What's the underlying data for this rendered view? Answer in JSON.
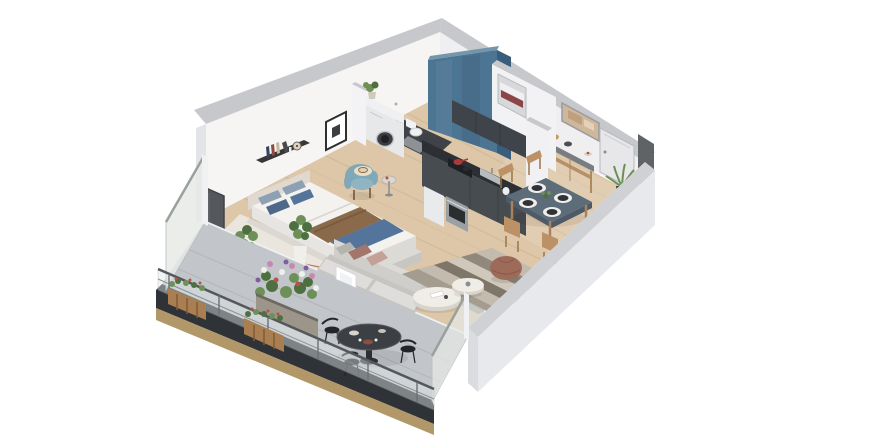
{
  "scene": {
    "type": "3d-isometric-apartment-floorplan-render",
    "background": "#ffffff",
    "rooms": [
      {
        "name": "bedroom",
        "furniture": [
          "double-bed",
          "headboard-shelf",
          "wall-art",
          "teal-armchair",
          "round-side-table",
          "window-plants",
          "beige-rug",
          "dark-window"
        ]
      },
      {
        "name": "bathroom",
        "furniture": [
          "blue-accent-wall",
          "vanity-sink",
          "washing-machine",
          "toilet",
          "bath-mat",
          "towel-niche"
        ]
      },
      {
        "name": "kitchen",
        "furniture": [
          "upper-cabinets",
          "dark-counter",
          "cooktop",
          "oven",
          "dishwasher",
          "sink"
        ]
      },
      {
        "name": "living-dining",
        "furniture": [
          "gray-sofa",
          "two-round-coffee-tables",
          "striped-rug",
          "leather-pouf",
          "dining-table",
          "dining-chairs",
          "console-table",
          "entry-door",
          "wall-art",
          "palm-plant",
          "dark-wardrobe-panel"
        ]
      },
      {
        "name": "balcony",
        "furniture": [
          "bistro-table",
          "bistro-chairs",
          "flower-planter",
          "railing-planter-boxes",
          "glass-railing",
          "frosted-privacy-screens",
          "concrete-floor"
        ]
      }
    ],
    "counts": {
      "dining_chairs": 4,
      "place_settings": 4,
      "bed_pillows": 4,
      "bistro_chairs": 3,
      "railing_posts": 6,
      "coffee_tables": 2,
      "railing_planters": 2
    },
    "colors": {
      "wallTop": "#c7c8cc",
      "wallFaceNW": "#f6f5f3",
      "wallFaceNE": "#efeff1",
      "wallCap": "#e3e4e7",
      "seWallTop": "#cfd1d5",
      "seWallFace": "#e8e9ec",
      "seWallInner": "#f4f4f2",
      "blueWall": "#4c7493",
      "blueWallSide": "#3a5d7c",
      "blueWallTop": "#7396ad",
      "woodFloor": "#ddc7a8",
      "plankLine": "#cbb390",
      "bathFloor": "#3f4348",
      "matGray": "#8e9296",
      "kitchenUpper": "#3f444a",
      "kitchenTop": "#2c3034",
      "kitchenFace": "#474c51",
      "steel": "#9ba0a5",
      "applianceWhite": "#e9eaec",
      "cooktopDark": "#1e2124",
      "potRed": "#a83c3c",
      "doorFace": "#e7e7e9",
      "doorEdge": "#b9bac0",
      "consoleWood": "#b08a5f",
      "consoleTop": "#787d82",
      "diningTop": "#5d6c79",
      "diningSide": "#4e5b66",
      "chairWood": "#bd9166",
      "chairWoodDark": "#9a7448",
      "plateDark": "#2f3338",
      "matWhite": "#f0efec",
      "artBeige": "#cfb79b",
      "artSmudge": "#b99877",
      "frameDark": "#2e2f31",
      "towelWhite": "#f0f0f2",
      "towelRed": "#8e4348",
      "nicheBack": "#d6d8da",
      "bedWhite": "#f3f2ef",
      "bedPlatform": "#e7e5e2",
      "bedFootSide": "#dcdad6",
      "headboard": "#e0d9cf",
      "pillowLight": "#8ea0b4",
      "pillowDark": "#4e6889",
      "pillowMid": "#54749c",
      "throwBrown": "#8b6a4c",
      "throwBrownDark": "#7a5b40",
      "throwBlue": "#54749c",
      "benchTop": "#dcdad7",
      "benchSide": "#c8c6c3",
      "rugBedroom": "#eae5dd",
      "rugStripeRed": "#b0614f",
      "sofaBase": "#c6c5c2",
      "sofaBack": "#cfcecb",
      "sofaBackTop": "#dbdad7",
      "sofaSeat": "#dedddb",
      "pillowBrown": "#a3766b",
      "pillowBlush": "#c4a198",
      "pillowGray": "#b5b3b0",
      "coffeeTop": "#f0ede7",
      "coffeeSide": "#d8d4cd",
      "rugBase": "#b7b0a5",
      "rugS1": "#a49c8e",
      "rugS2": "#c2bbae",
      "rugS3": "#7d7669",
      "rugS4": "#cfc8bb",
      "rugS5": "#8f887b",
      "pouf": "#9e6b5a",
      "poufDark": "#8a5a4a",
      "balconyFloor": "#c2c6ca",
      "balconySeam": "#b2b6ba",
      "slabDark": "#2f3236",
      "slabWood": "#b29869",
      "glass": "#dfe6e6",
      "glassFrame": "#a8adaf",
      "handrail": "#54585c",
      "midrail": "#8b9094",
      "post": "#6b7074",
      "screenGlass": "#e7eae7",
      "screenFrame": "#b9bfbc",
      "screenRail": "#9aa09c",
      "planterWood": "#a97f52",
      "planterSlat": "#7e5c38",
      "planterBox": "#9b958a",
      "planterRim": "#6e6960",
      "green": "#6d9058",
      "greenDark": "#4e7040",
      "flowerWhite": "#eef0ea",
      "flowerPink": "#cc85b1",
      "flowerPurple": "#7d5f9e",
      "flowerRed": "#b5524c",
      "bistro": "#3c4044",
      "bistroRim": "#585c60",
      "bistroDark": "#232528",
      "teal": "#7fa9b8",
      "tealLight": "#8fb4c2",
      "hat": "#e8dfc6",
      "hatBand": "#8a6a4e",
      "windowDark": "#54585d",
      "windowFrameDark": "#3f4347",
      "sillWhite": "#eef0f1",
      "potWhite": "#e4e1da",
      "potDark": "#3c3e40",
      "bookNavy": "#31465c",
      "bookRed": "#8c4a42",
      "bookBeige": "#c7b89c",
      "bookGray": "#4a4a4a",
      "clockFace": "#ddd2bd",
      "shelfDark": "#35373a",
      "shadow": "#000000"
    }
  }
}
